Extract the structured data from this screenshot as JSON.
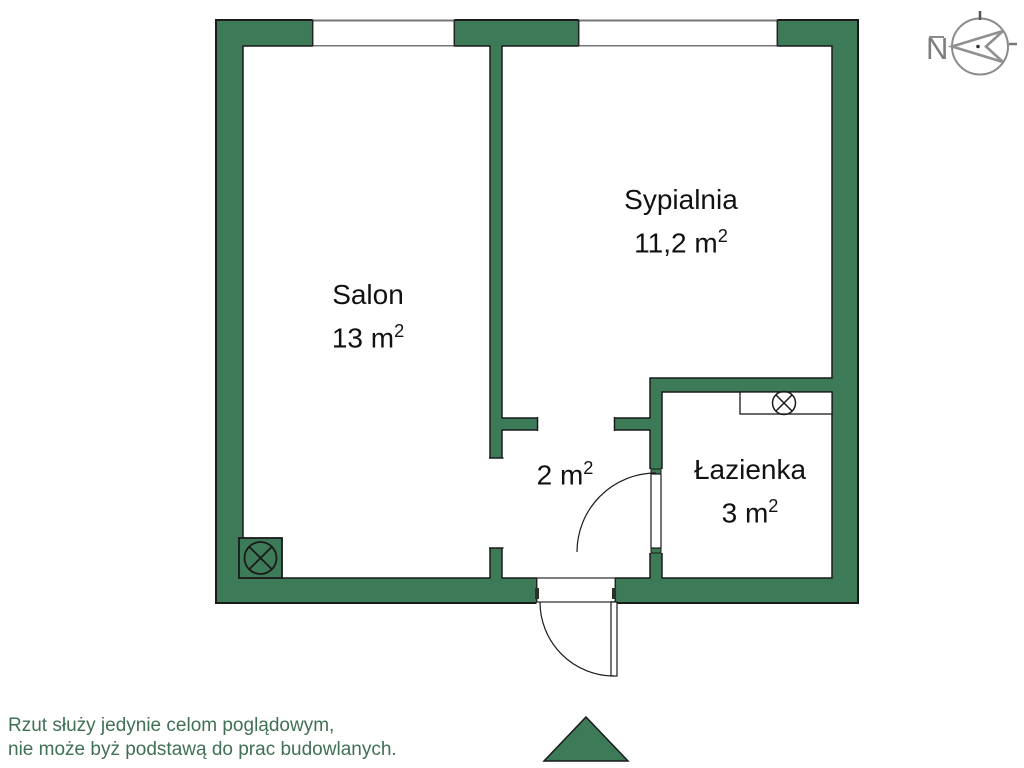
{
  "floorplan": {
    "rooms": [
      {
        "id": "salon",
        "name": "Salon",
        "area": "13 m",
        "area_sup": "2"
      },
      {
        "id": "sypialnia",
        "name": "Sypialnia",
        "area": "11,2 m",
        "area_sup": "2"
      },
      {
        "id": "lazienka",
        "name": "Łazienka",
        "area": "3 m",
        "area_sup": "2"
      },
      {
        "id": "przedpokoj",
        "name": "",
        "area": "2 m",
        "area_sup": "2"
      }
    ],
    "compass_label": "N",
    "disclaimer": [
      "Rzut służy jedynie celom poglądowym,",
      "nie może byż podstawą do prac budowlanych."
    ]
  },
  "colors": {
    "wall_green": "#3D7A57",
    "outline_black": "#1a1a1a",
    "disclaimer_green": "#407055",
    "compass_gray": "#8a8a8a"
  }
}
